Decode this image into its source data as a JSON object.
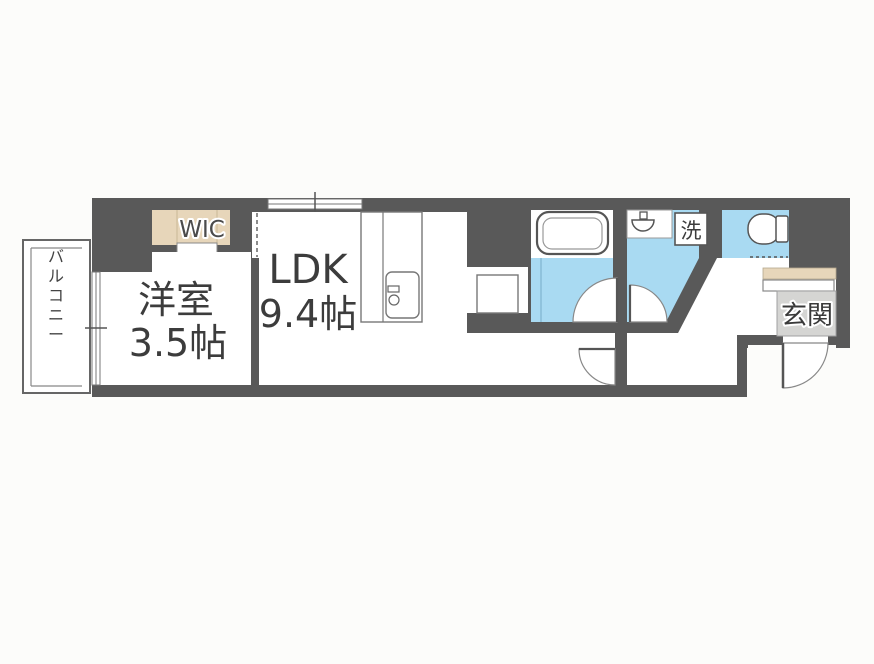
{
  "document": {
    "type": "apartment-floor-plan"
  },
  "rooms": {
    "living": {
      "label_line1": "LDK",
      "label_line2": "9.4帖"
    },
    "bedroom": {
      "label_line1": "洋室",
      "label_line2": "3.5帖"
    },
    "wic": {
      "label": "WIC"
    },
    "balcony": {
      "label": "バルコニー"
    },
    "entrance": {
      "label": "玄関"
    },
    "laundry": {
      "label": "洗"
    }
  },
  "colors": {
    "wall_dark": "#595959",
    "wet_area_blue": "#a9daf2",
    "closet_beige": "#e7d6ba",
    "entrance_gray": "#d5d5d3",
    "line_gray": "#8a8a8a",
    "text_dark": "#3c3c3c",
    "background": "#fcfcfa"
  }
}
